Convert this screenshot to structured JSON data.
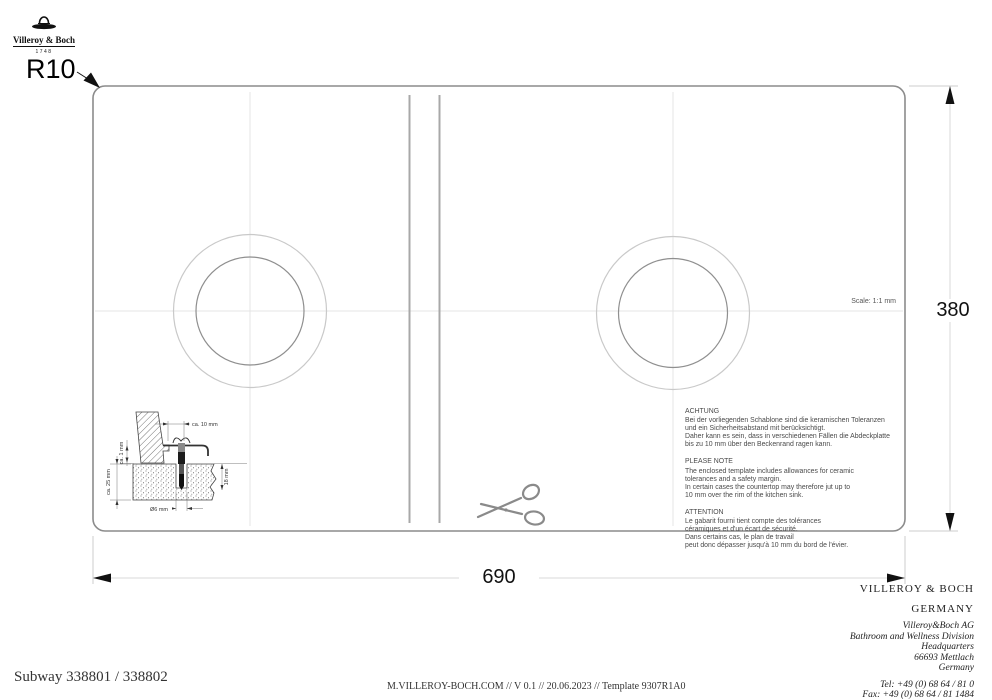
{
  "colors": {
    "ink": "#111111",
    "template_border": "#8c8c8c",
    "cut_line_gray": "#a8a8a8",
    "faint_centerline": "#e4e4e4"
  },
  "brand": {
    "name": "Villeroy & Boch",
    "year": "1748"
  },
  "drawing": {
    "corner_radius": "R10",
    "width_mm": "690",
    "height_mm": "380",
    "scale": "Scale: 1:1 mm"
  },
  "detail": {
    "dim_top": "ca. 10 mm",
    "dim_gap": "ca. 1 mm",
    "dim_thickness": "ca. 25 mm",
    "dim_depth": "18 mm",
    "dim_diameter": "Ø6 mm"
  },
  "notes": {
    "de": {
      "heading": "ACHTUNG",
      "body": "Bei der vorliegenden Schablone sind die keramischen Toleranzen\nund ein Sicherheitsabstand mit berücksichtigt.\nDaher kann es sein, dass in verschiedenen Fällen die Abdeckplatte\nbis zu 10 mm über den Beckenrand ragen kann."
    },
    "en": {
      "heading": "PLEASE NOTE",
      "body": "The enclosed template includes allowances for ceramic\ntolerances and a safety margin.\nIn certain cases the countertop may therefore jut up to\n10 mm over the rim of the kitchen sink."
    },
    "fr": {
      "heading": "ATTENTION",
      "body": "Le gabarit fourni tient compte des tolérances\ncéramiques et d'un écart de sécurité.\nDans certains cas, le plan de travail\npeut donc dépasser jusqu'à 10 mm du bord de l'évier."
    }
  },
  "footer": {
    "product": "Subway 338801 / 338802",
    "meta": "M.VILLEROY-BOCH.COM // V 0.1 // 20.06.2023 // Template 9307R1A0",
    "company": "VILLEROY & BOCH",
    "country": "GERMANY",
    "address": "Villeroy&Boch AG\nBathroom and Wellness Division\nHeadquarters\n66693 Mettlach\nGermany",
    "contact": "Tel: +49 (0) 68 64 / 81 0\nFax: +49 (0) 68 64 / 81 1484"
  }
}
